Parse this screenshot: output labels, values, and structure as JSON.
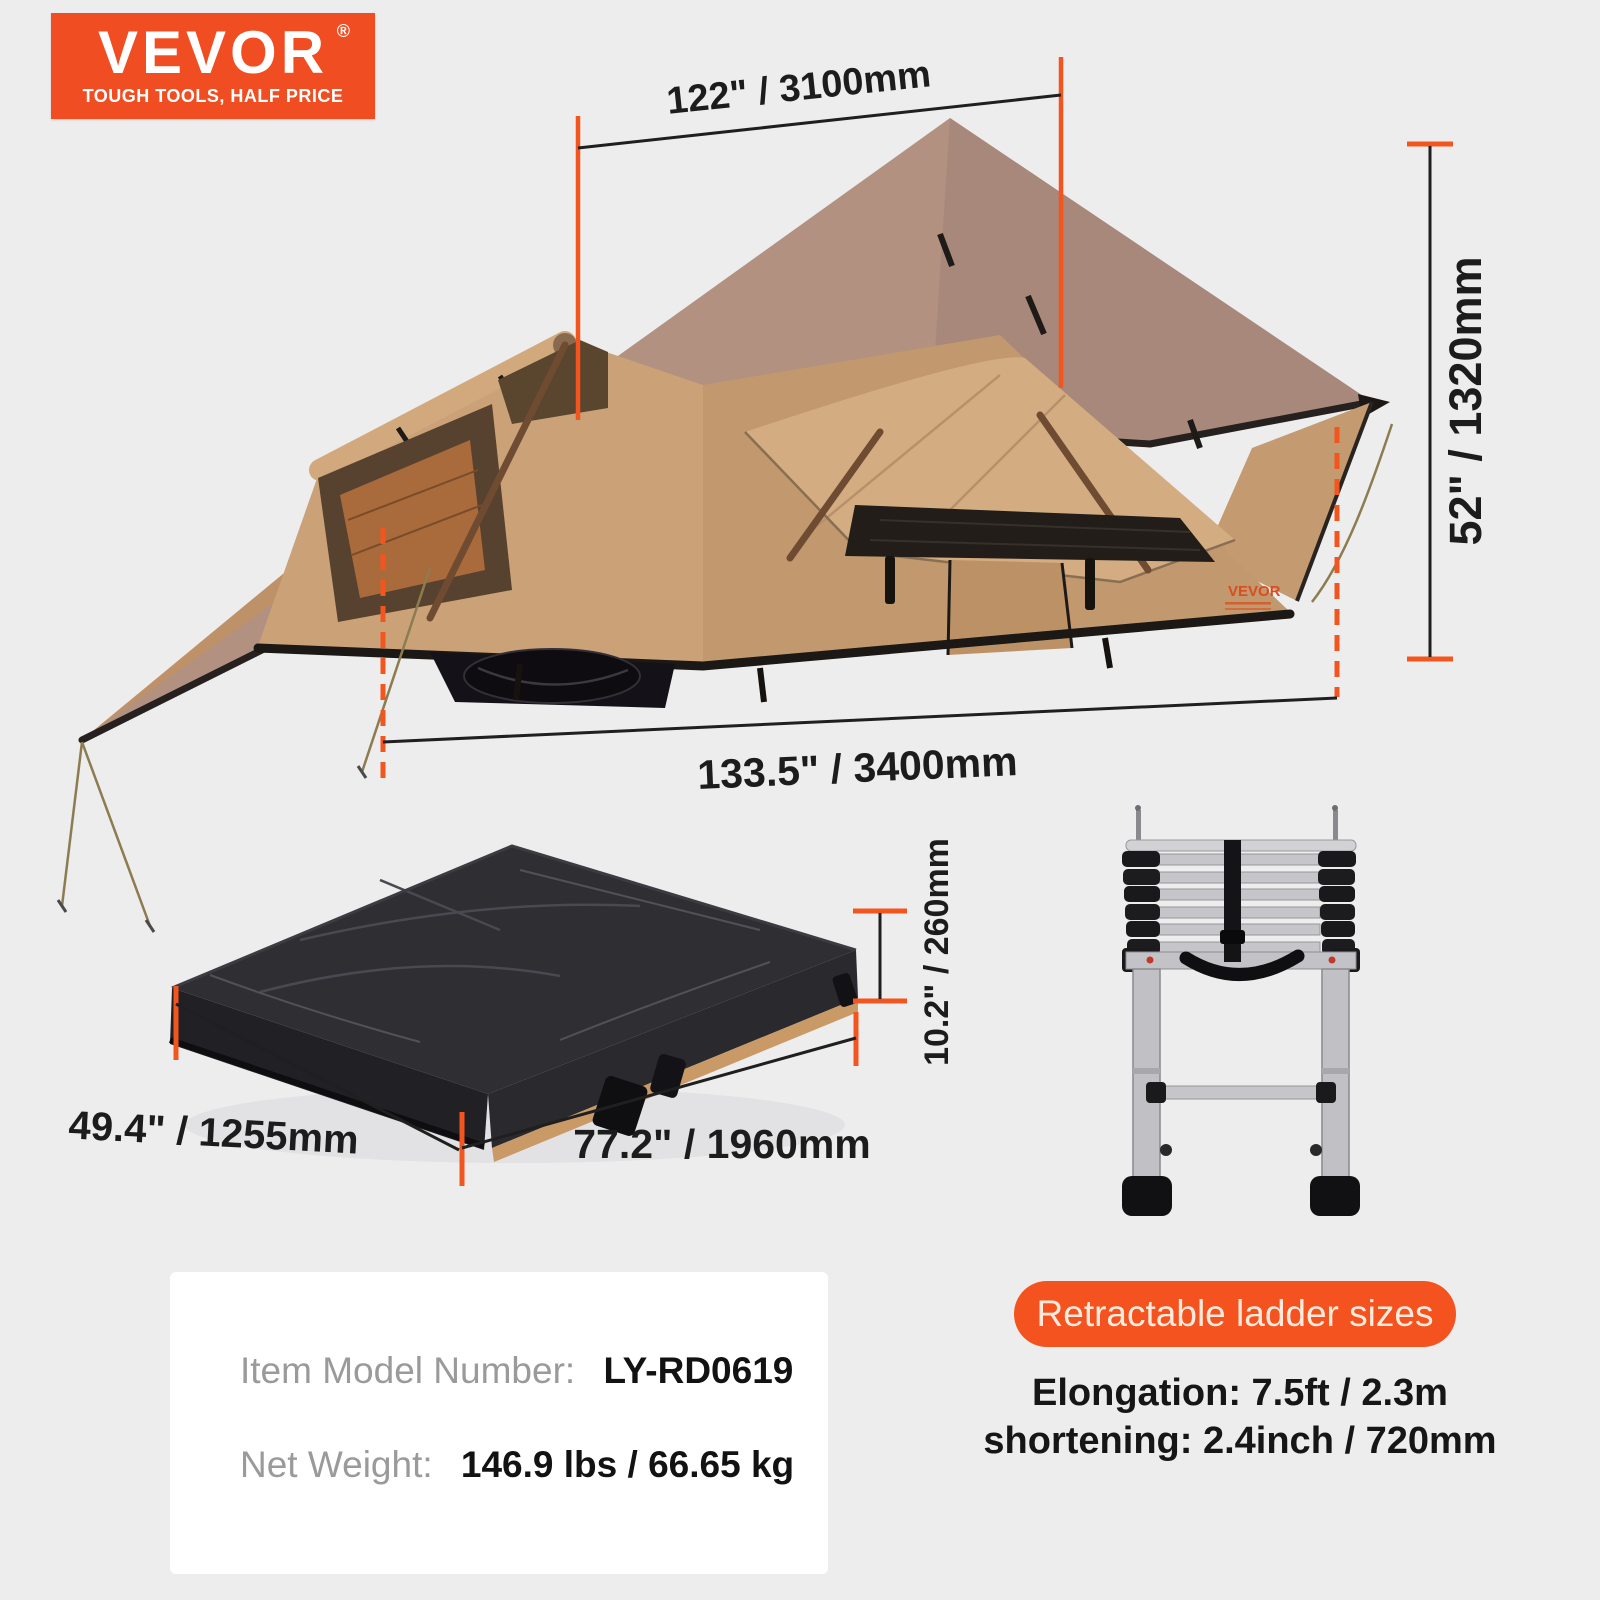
{
  "logo": {
    "brand": "VEVOR",
    "registered": "®",
    "tagline": "TOUGH TOOLS, HALF PRICE"
  },
  "colors": {
    "accent_orange": "#F3551F",
    "logo_orange": "#F04E22",
    "badge_orange": "#F4521E",
    "background": "#EDEDEE",
    "card_white": "#FFFFFF",
    "dimension_text": "#1C1C1C",
    "label_gray": "#9A9A9A",
    "tent_fabric": "#C79E74",
    "roof_fabric": "#B29181"
  },
  "tent": {
    "brand_label": "VEVOR",
    "dims": {
      "top": "122\" / 3100mm",
      "side": "52\" / 1320mm",
      "bottom": "133.5\" / 3400mm"
    }
  },
  "folded": {
    "dims": {
      "left": "49.4\" / 1255mm",
      "bottom": "77.2\" / 1960mm",
      "height": "10.2\" / 260mm"
    }
  },
  "specs": {
    "model_label": "Item Model Number:",
    "model_value": "LY-RD0619",
    "weight_label": "Net Weight:",
    "weight_value": "146.9 lbs / 66.65 kg"
  },
  "ladder": {
    "badge": "Retractable ladder sizes",
    "elongation": "Elongation: 7.5ft / 2.3m",
    "shortening": "shortening: 2.4inch / 720mm"
  }
}
